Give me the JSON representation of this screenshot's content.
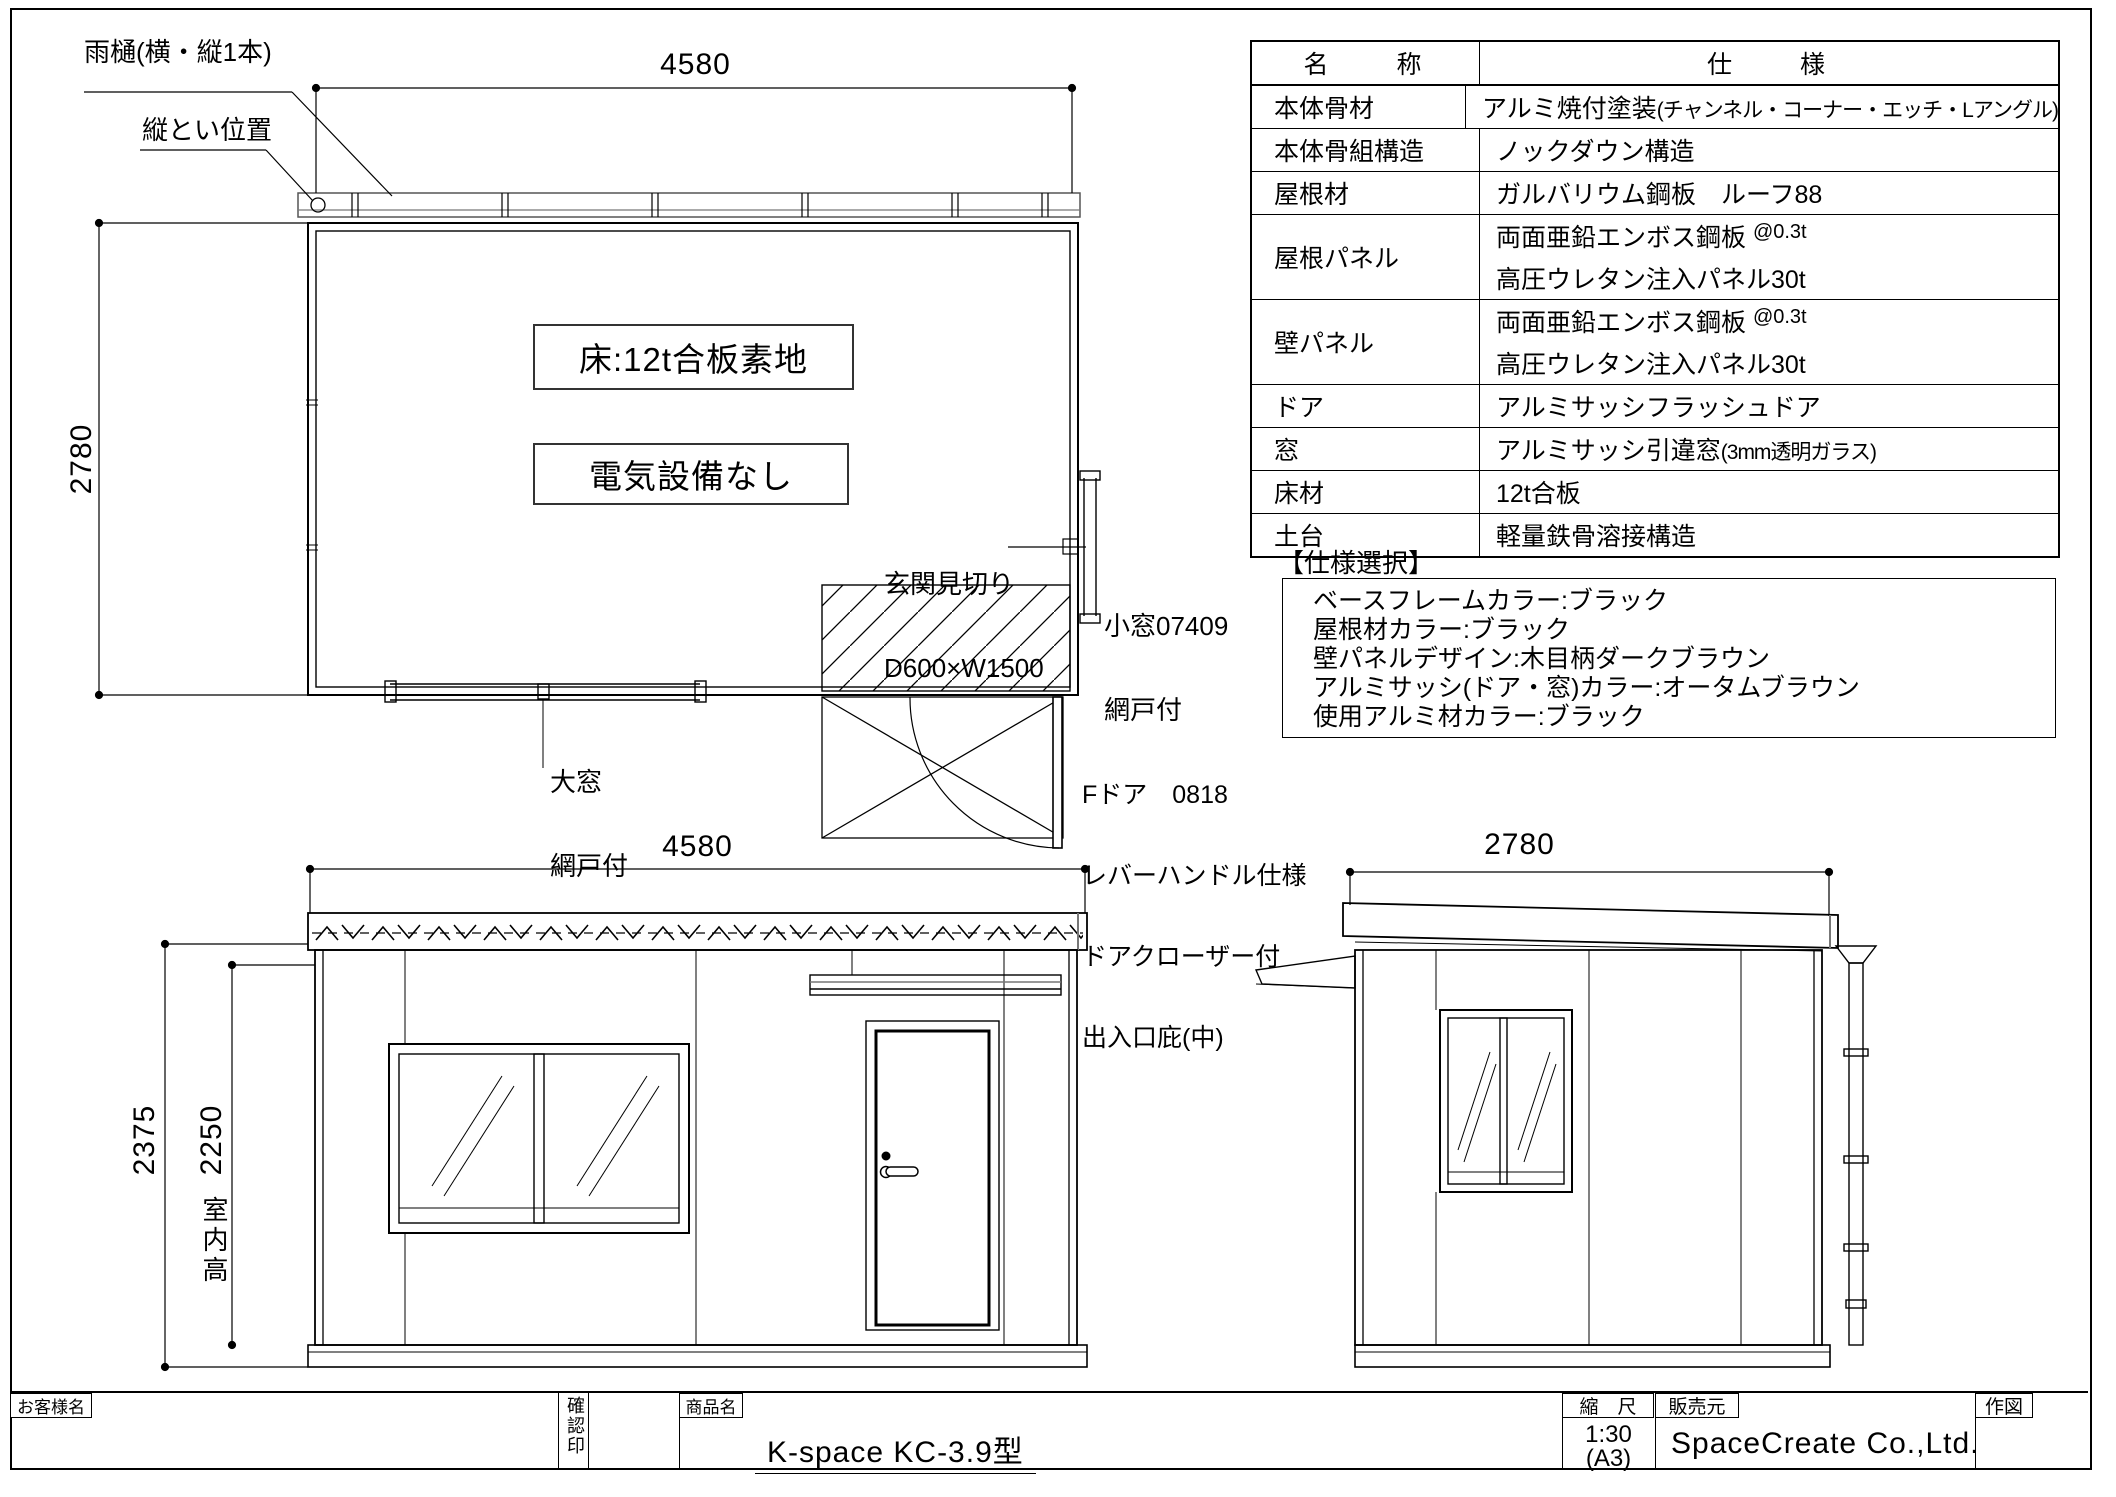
{
  "drawing": {
    "plan": {
      "dim_width": "4580",
      "dim_depth": "2780",
      "gutter_label": "雨樋(横・縦1本)",
      "downspout_label": "縦とい位置",
      "floor_note": "床:12t合板素地",
      "electric_note": "電気設備なし",
      "entrance_line1": "玄関見切り",
      "entrance_line2": "D600×W1500",
      "small_window_line1": "小窓07409",
      "small_window_line2": "網戸付",
      "large_window_line1": "大窓",
      "large_window_line2": "網戸付",
      "door_line1": "Fドア　0818",
      "door_line2": "レバーハンドル仕様",
      "door_line3": "ドアクローザー付",
      "door_line4": "出入口庇(中)"
    },
    "front_elevation": {
      "dim_width": "4580",
      "dim_total_height": "2375",
      "dim_interior_height": "2250",
      "interior_height_label": "室内高"
    },
    "side_elevation": {
      "dim_depth": "2780"
    }
  },
  "spec_table": {
    "header": {
      "name": "名　　称",
      "spec": "仕　　様"
    },
    "rows": [
      {
        "name": "本体骨材",
        "line1": "アルミ焼付塗装",
        "line1_small": "(チャンネル・コーナー・エッチ・Lアングル)"
      },
      {
        "name": "本体骨組構造",
        "line1": "ノックダウン構造"
      },
      {
        "name": "屋根材",
        "line1": "ガルバリウム鋼板　ルーフ88"
      },
      {
        "name": "屋根パネル",
        "line1": "両面亜鉛エンボス鋼板 ",
        "line1_sup": "@0.3t",
        "line2": "高圧ウレタン注入パネル30t"
      },
      {
        "name": "壁パネル",
        "line1": "両面亜鉛エンボス鋼板 ",
        "line1_sup": "@0.3t",
        "line2": "高圧ウレタン注入パネル30t"
      },
      {
        "name": "ドア",
        "line1": "アルミサッシフラッシュドア"
      },
      {
        "name": "窓",
        "line1": "アルミサッシ引違窓",
        "line1_small": "(3mm透明ガラス)"
      },
      {
        "name": "床材",
        "line1": "12t合板"
      },
      {
        "name": "土台",
        "line1": "軽量鉄骨溶接構造"
      }
    ]
  },
  "spec_select": {
    "title": "【仕様選択】",
    "items": [
      "ベースフレームカラー:ブラック",
      "屋根材カラー:ブラック",
      "壁パネルデザイン:木目柄ダークブラウン",
      "アルミサッシ(ドア・窓)カラー:オータムブラウン",
      "使用アルミ材カラー:ブラック"
    ]
  },
  "title_block": {
    "customer_label": "お客様名",
    "stamp_label": "確認印",
    "product_label": "商品名",
    "product_name": "K-space KC-3.9型",
    "scale_label": "縮　尺",
    "scale_value": "1:30",
    "scale_paper": "(A3)",
    "seller_label": "販売元",
    "seller_name": "SpaceCreate Co.,Ltd.",
    "drawn_label": "作図"
  }
}
